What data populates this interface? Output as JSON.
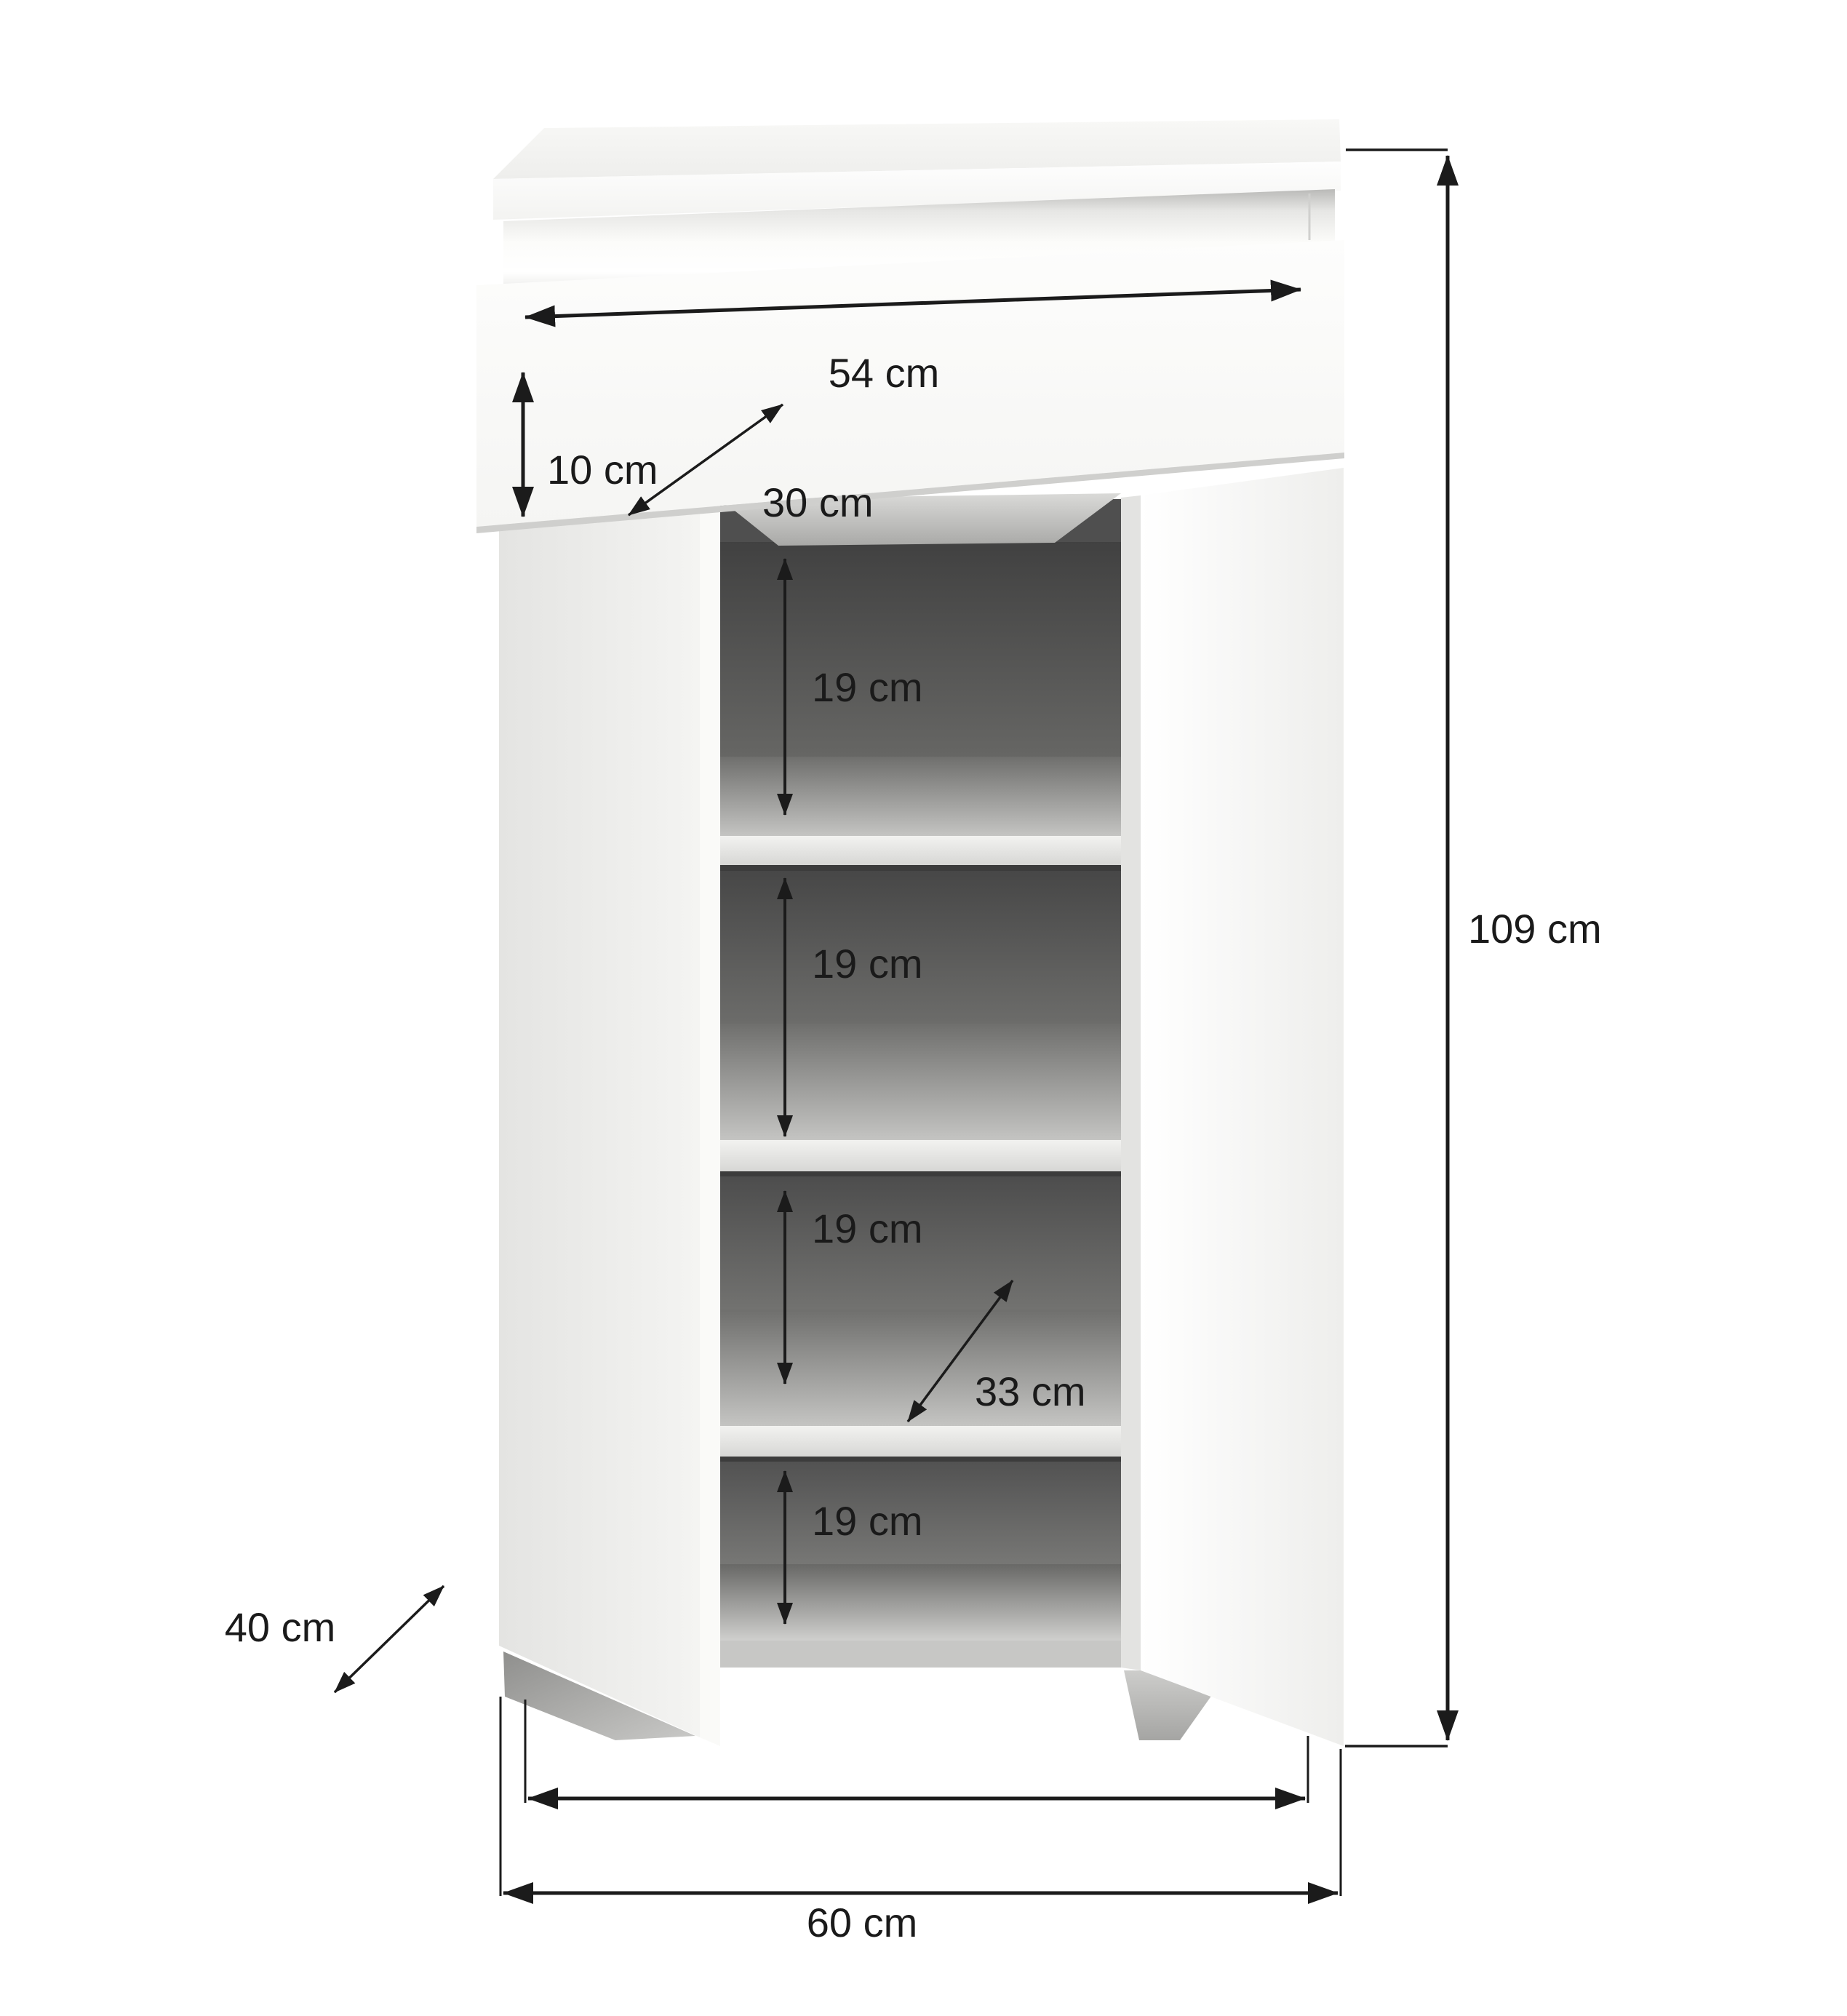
{
  "meta": {
    "type": "furniture-dimension-diagram",
    "subject": "two-door shoe cabinet with top drawer, open doors showing four shelf compartments"
  },
  "colors": {
    "background": "#ffffff",
    "line": "#1b1b1b",
    "text": "#1a1a1a",
    "cabinet_white": "#fbfbf9",
    "interior_dark": "#4f4f4f",
    "shelf_strip": "#e6e6e4"
  },
  "dimensions": {
    "top_width": {
      "value": 54,
      "unit": "cm",
      "label": "54 cm"
    },
    "drawer_height": {
      "value": 10,
      "unit": "cm",
      "label": "10 cm"
    },
    "drawer_depth": {
      "value": 30,
      "unit": "cm",
      "label": "30 cm"
    },
    "shelf_gaps": [
      {
        "value": 19,
        "unit": "cm",
        "label": "19 cm"
      },
      {
        "value": 19,
        "unit": "cm",
        "label": "19 cm"
      },
      {
        "value": 19,
        "unit": "cm",
        "label": "19 cm"
      },
      {
        "value": 19,
        "unit": "cm",
        "label": "19 cm"
      }
    ],
    "shelf_depth": {
      "value": 33,
      "unit": "cm",
      "label": "33 cm"
    },
    "total_height": {
      "value": 109,
      "unit": "cm",
      "label": "109 cm"
    },
    "total_depth": {
      "value": 40,
      "unit": "cm",
      "label": "40 cm"
    },
    "total_width": {
      "value": 60,
      "unit": "cm",
      "label": "60 cm"
    }
  }
}
